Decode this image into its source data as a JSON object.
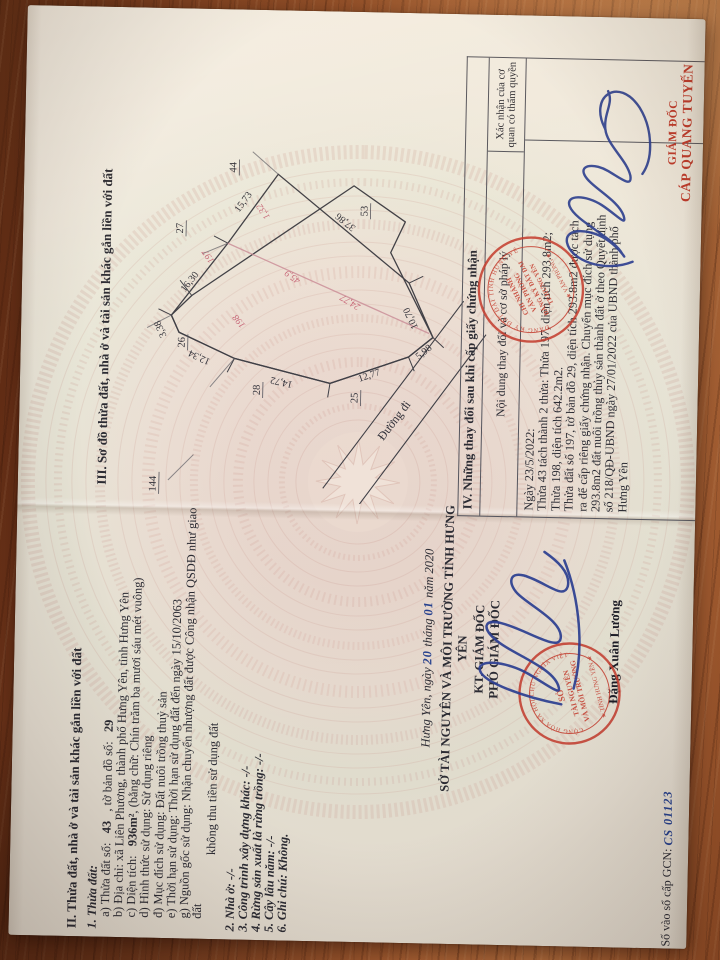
{
  "doc": {
    "sec2": {
      "heading": "II. Thửa đất, nhà ở và tài sản khác gắn liền với đất",
      "sub1": "1. Thửa đất:",
      "a_pre": "a) Thửa đất số:",
      "a_v1": "43",
      "a_mid": ", tờ bản đồ số:",
      "a_v2": "29",
      "b": "b) Địa chỉ: xã Liên Phương, thành phố Hưng Yên, tỉnh Hưng Yên",
      "c_pre": "c) Diện tích:",
      "c_v1": "936m²",
      "c_post": ", (bằng chữ: Chín trăm ba mươi sáu mét vuông)",
      "d": "d) Hình thức sử dụng: Sử dụng riêng",
      "dd": "đ) Mục đích sử dụng: Đất nuôi trồng thuỷ sản",
      "e": "e) Thời hạn sử dụng: Thời hạn sử dụng đất đến ngày 15/10/2063",
      "g": "g) Nguồn gốc sử dụng: Nhận chuyển nhượng đất được Công nhận QSDĐ như giao đất",
      "g2": "không thu tiền sử dụng đất",
      "i2": "2. Nhà ở: -/-",
      "i3": "3. Công trình xây dựng khác: -/-",
      "i4": "4. Rừng sản xuất là rừng trồng: -/-",
      "i5": "5. Cây lâu năm: -/-",
      "i6": "6. Ghi chú: Không."
    },
    "sign": {
      "date_pre": "Hưng Yên, ngày",
      "date_day": "20",
      "date_mid": "tháng",
      "date_month": "01",
      "date_post": "năm 2020",
      "agency": "SỞ TÀI NGUYÊN VÀ MÔI TRƯỜNG TỈNH HƯNG YÊN",
      "kt": "KT. GIÁM ĐỐC",
      "title": "PHÓ GIÁM ĐỐC",
      "name": "Đặng Xuân Lương"
    },
    "seal_left": {
      "arc_top": "CỘNG HÒA XÃ HỘI CHỦ NGHĨA VIỆT NAM",
      "arc_bottom": "★ TỈNH HƯNG YÊN ★",
      "c1": "SỞ",
      "c2": "TÀI NGUYÊN",
      "c3": "VÀ MÔI TRƯỜNG"
    },
    "sec3": {
      "heading": "III. Sơ đồ thửa đất, nhà ở và tài sản khác gắn liền với đất",
      "diagram": {
        "edges": {
          "e1573": "15,73",
          "e1630": "16,30",
          "e338": "3,38",
          "e1234": "12,34",
          "e1472": "14,72",
          "e1277": "12,77",
          "e598": "5,98",
          "e1070": "10,70",
          "e3786": "37,86"
        },
        "neighbors": {
          "n44": "44",
          "n27": "27",
          "n144": "144",
          "n26": "26",
          "n28": "28",
          "n25": "25",
          "n53": "53"
        },
        "red": {
          "r197": "197",
          "r132": "1,32",
          "r459": "45,9",
          "r2477": "24,77",
          "r198": "198"
        },
        "road": "Đường đi"
      }
    },
    "sec4": {
      "heading": "IV. Những thay đổi sau khi cấp giấy chứng nhận",
      "col1": "Nội dung thay đổi và cơ sở pháp lý",
      "col2": "Xác nhận của cơ quan có thẩm quyền",
      "l1": "Ngày 23/5/2022:",
      "l2": "Thửa 43 tách thành 2 thửa: Thửa 197, diện tích 293.8m2;",
      "l3": "Thửa 198, diện tích 642.2m2.",
      "l4": "Thửa đất số 197, tờ bản đồ 29, diện tích 293.8m2 được tách",
      "l5": "ra để cấp riêng giấy chứng nhận. Chuyển mục đích sử dụng",
      "l6": "293.8m2 đất nuôi trồng thủy sản thành đất ở theo Quyết định",
      "l7": "số 218/QĐ-UBND ngày 27/01/2022 của UBND thành phố",
      "l8": "Hưng Yên",
      "confirm_title": "GIÁM ĐỐC",
      "confirm_name": "CÁP QUANG TUYẾN"
    },
    "seal_right": {
      "arc_top": "ĐĂNG KÝ ĐẤT ĐAI TỈNH HƯNG YÊN",
      "arc_bottom": "★ VĂN PHÒNG ★",
      "c1": "CHI NHÁNH",
      "c2": "VĂN PHÒNG",
      "c3": "ĐĂNG KÝ ĐẤT ĐAI",
      "c4": "TP.HƯNG YÊN"
    },
    "footer": {
      "gcn_label": "Số vào sổ cấp GCN:",
      "gcn_value": "CS 01123"
    }
  },
  "colors": {
    "seal_red": "#c23a2c",
    "ink_blue": "#2b3e91",
    "red_mark": "#c2556b",
    "wood": "#8a4a26"
  }
}
